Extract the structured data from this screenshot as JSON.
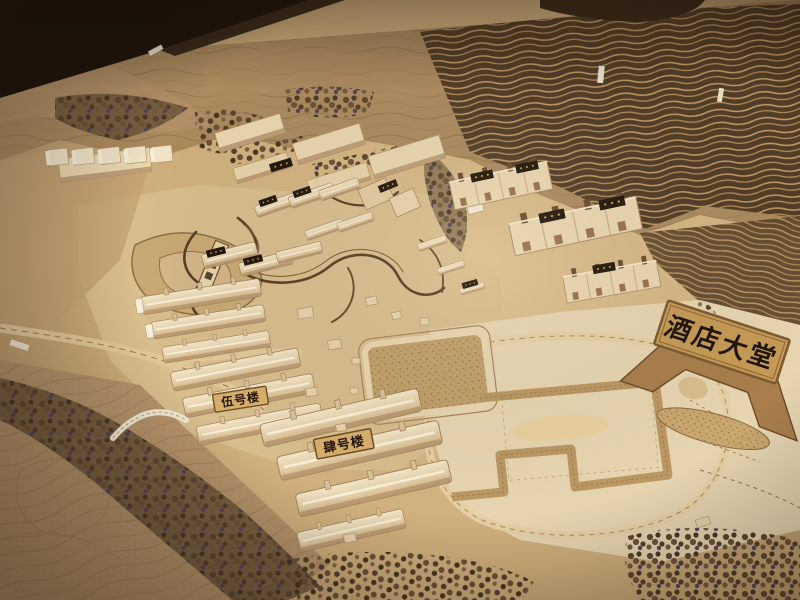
{
  "photo": {
    "description": "Photograph of a wooden architectural site model (laser-cut topography, tree clumps, gabled building blocks) of a resort/hotel masterplan with Chinese name plaques",
    "signs": {
      "hotel_lobby": "酒店大堂",
      "building_no5": "伍号楼",
      "building_no4": "肆号楼"
    },
    "palette": {
      "table_dark": "#20150c",
      "hill_tan": "#ab8a5f",
      "terrace_dark": "#4e3a24",
      "terrace_line": "#c49a66",
      "site_pale": "#d8bd8d",
      "plywood_light": "#e7d5b1",
      "building_light": "#f2e4c8",
      "building_shadow": "#b3916a",
      "tree_dark": "#4c3a26",
      "stream_dark": "#573f24",
      "label_chip": "#231709",
      "plaque_gold": "#c59a55",
      "plaque_text": "#241505"
    }
  }
}
